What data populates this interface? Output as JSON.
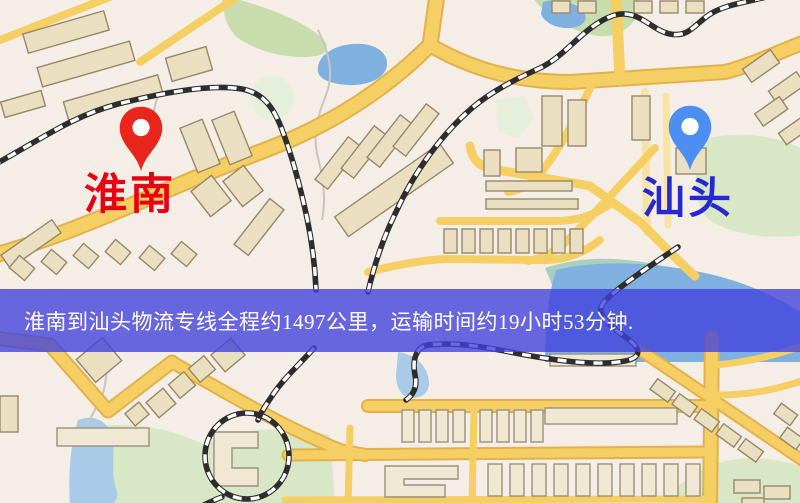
{
  "origin": {
    "name": "淮南",
    "label_color": "#e60012",
    "pin_color": "#e8261d"
  },
  "destination": {
    "name": "汕头",
    "label_color": "#2828d2",
    "pin_color": "#4d8ef2"
  },
  "banner": {
    "text": "淮南到汕头物流专线全程约1497公里，运输时间约19小时53分钟.",
    "bg_color": "#4040dc",
    "text_color": "#ffffff"
  },
  "route": {
    "origin_city": "淮南",
    "destination_city": "汕头",
    "distance_km": 1497,
    "duration_hours": 19,
    "duration_minutes": 53
  },
  "map_colors": {
    "background": "#f4eee7",
    "road": "#f5cf63",
    "building": "#eadfc1",
    "water": "#7fb0df",
    "park": "#d8e8c6",
    "railway": "#2d2d2d"
  }
}
